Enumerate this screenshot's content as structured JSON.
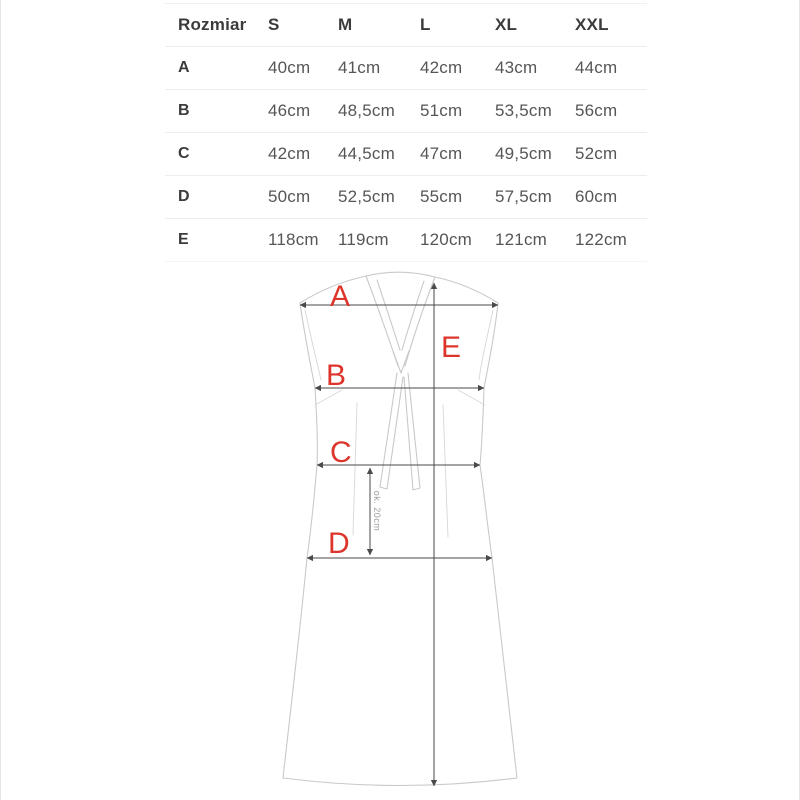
{
  "theme": {
    "accent": "#dd352c",
    "measure": "#4a4a4a",
    "outline": "#c9c9c9",
    "detail": "#d7d7d7",
    "note-gray": "#9c9c9c",
    "text-dark": "#3b3b3b",
    "text-gray": "#565656",
    "divider": "#ededed"
  },
  "table": {
    "headers": [
      "Rozmiar",
      "S",
      "M",
      "L",
      "XL",
      "XXL"
    ],
    "rows": [
      {
        "label": "A",
        "values": [
          "40cm",
          "41cm",
          "42cm",
          "43cm",
          "44cm"
        ]
      },
      {
        "label": "B",
        "values": [
          "46cm",
          "48,5cm",
          "51cm",
          "53,5cm",
          "56cm"
        ]
      },
      {
        "label": "C",
        "values": [
          "42cm",
          "44,5cm",
          "47cm",
          "49,5cm",
          "52cm"
        ]
      },
      {
        "label": "D",
        "values": [
          "50cm",
          "52,5cm",
          "55cm",
          "57,5cm",
          "60cm"
        ]
      },
      {
        "label": "E",
        "values": [
          "118cm",
          "119cm",
          "120cm",
          "121cm",
          "122cm"
        ]
      }
    ]
  },
  "diagram": {
    "labels": {
      "a": "A",
      "b": "B",
      "c": "C",
      "d": "D",
      "e": "E"
    },
    "note": "ok. 20cm"
  }
}
